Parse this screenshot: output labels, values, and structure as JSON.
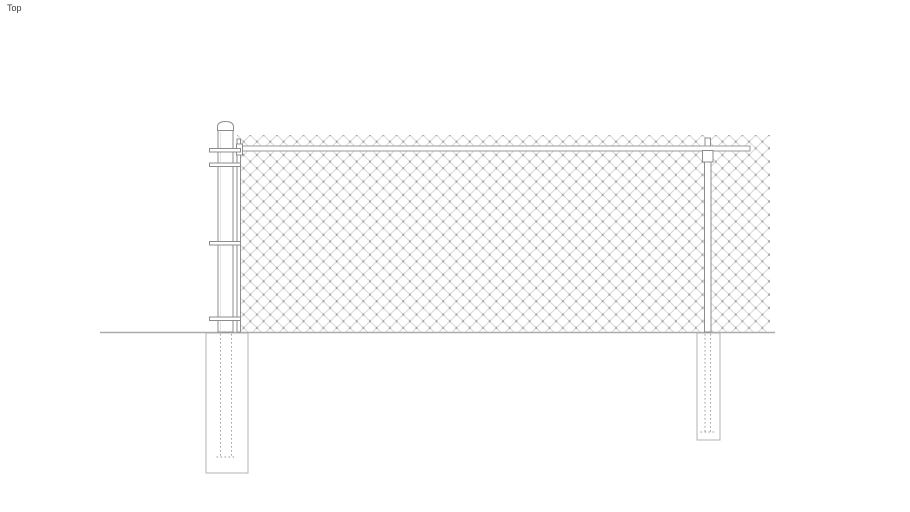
{
  "view": {
    "label": "Top"
  },
  "colors": {
    "background": "#ffffff",
    "label_text": "#3c3c3c",
    "mesh_line": "#cfcfcf",
    "mesh_knot": "#9e9e9e",
    "line_fitting": "#8c8c8c",
    "line_rail": "#9a9a9a",
    "line_ground": "#ababab",
    "line_footing": "#b3b3b3",
    "line_hidden": "#9a9a9a",
    "post_shade": "#dcdcdc"
  }
}
